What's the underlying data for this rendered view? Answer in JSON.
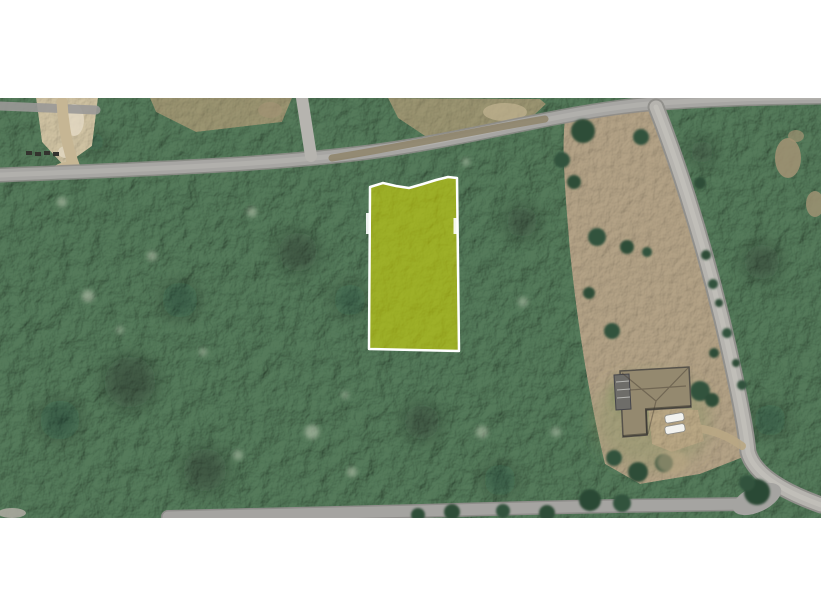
{
  "scene": {
    "type": "satellite-aerial-view",
    "description": "Aerial/satellite photo of wooded lots: a yellow-highlighted parcel outlined in white fronts a diagonal road; a second road curves down the right side past a cleared field with a house, driveway and two parked cars; dense tree canopy covers the rest; white letterbox bands above and below the photo."
  },
  "colors": {
    "page_bg": "#ffffff",
    "forest_base": "#547a5a",
    "field_base": "#b3a286",
    "road_body": "#a7a6a3",
    "road_edge": "#8e8d8a",
    "road_light_body": "#b6b4af",
    "road_center": "#bcbab6",
    "dirt_path": "#c6b694",
    "clearing_tan": "#a89a76",
    "bare_dirt": "#cfc2a2",
    "parcel_fill": "rgba(219,220,0,0.55)",
    "parcel_stroke": "#ffffff",
    "roof": "#94896f",
    "roof_dark": "#6e6d69",
    "driveway": "#b9a784",
    "car_body": "#f3f3ef",
    "tree_dark": "#2f4d38",
    "shadow_blob": "rgba(16,34,20,0.35)",
    "canopy_gap": "rgba(193,202,182,0.55)"
  },
  "parcel": {
    "label": "highlighted-lot",
    "points": "370,187 383,183 396,186 409,188 423,184 436,180 448,177 457,178 459,351 369,349",
    "tick_left_path": "M 368 213 L 368 234",
    "tick_right_path": "M 455 218 L 455 234"
  },
  "roads": {
    "main_path": "M 0 175 C 120 170 260 166 370 152 C 470 139 560 112 648 104 C 710 99 770 98 821 97",
    "branch_path": "M 302 98 L 311 156",
    "top_left_stub_path": "M 0 106 L 96 110",
    "right_path": "M 656 107 C 675 155 700 230 722 320 C 735 375 745 422 748 452 C 754 474 782 491 821 505",
    "bottom_path": "M 168 517 L 420 511 C 550 507 660 505 748 504",
    "dirt_driveway_path": "M 62 102 C 63 125 68 150 75 168",
    "house_access_path": "M 697 428 C 715 431 728 436 742 446",
    "shoulder_scrub_path": "M 332 158 C 400 147 470 132 545 119"
  },
  "field": {
    "outline_path": "M 565 118 L 650 104 C 678 160 700 240 722 320 C 735 375 743 425 746 456 L 700 474 L 640 484 L 605 464 C 592 412 578 332 570 252 C 566 202 561 150 565 118 Z"
  },
  "clearings": {
    "bare_dirt_points": "36,98 98,98 92,146 64,166 42,142",
    "tan_left_points": "150,98 292,98 282,122 196,132 156,112",
    "tan_mid_points": "388,98 540,99 546,104 520,128 428,138 398,118"
  },
  "house": {
    "roof_path": "M 620 371 L 689 367 L 691 407 L 646 410 L 647 435 L 623 437 Z",
    "deck_path": "M 614 375 L 629 374 L 631 409 L 616 410 Z",
    "ridge_path": "M 622 373 L 656 401 M 688 368 L 656 401 M 656 401 L 648 434 M 630 390 L 686 386",
    "driveway_path": "M 648 406 L 698 410 L 704 441 L 672 452 L 652 444 Z",
    "parked_cars": 2
  }
}
